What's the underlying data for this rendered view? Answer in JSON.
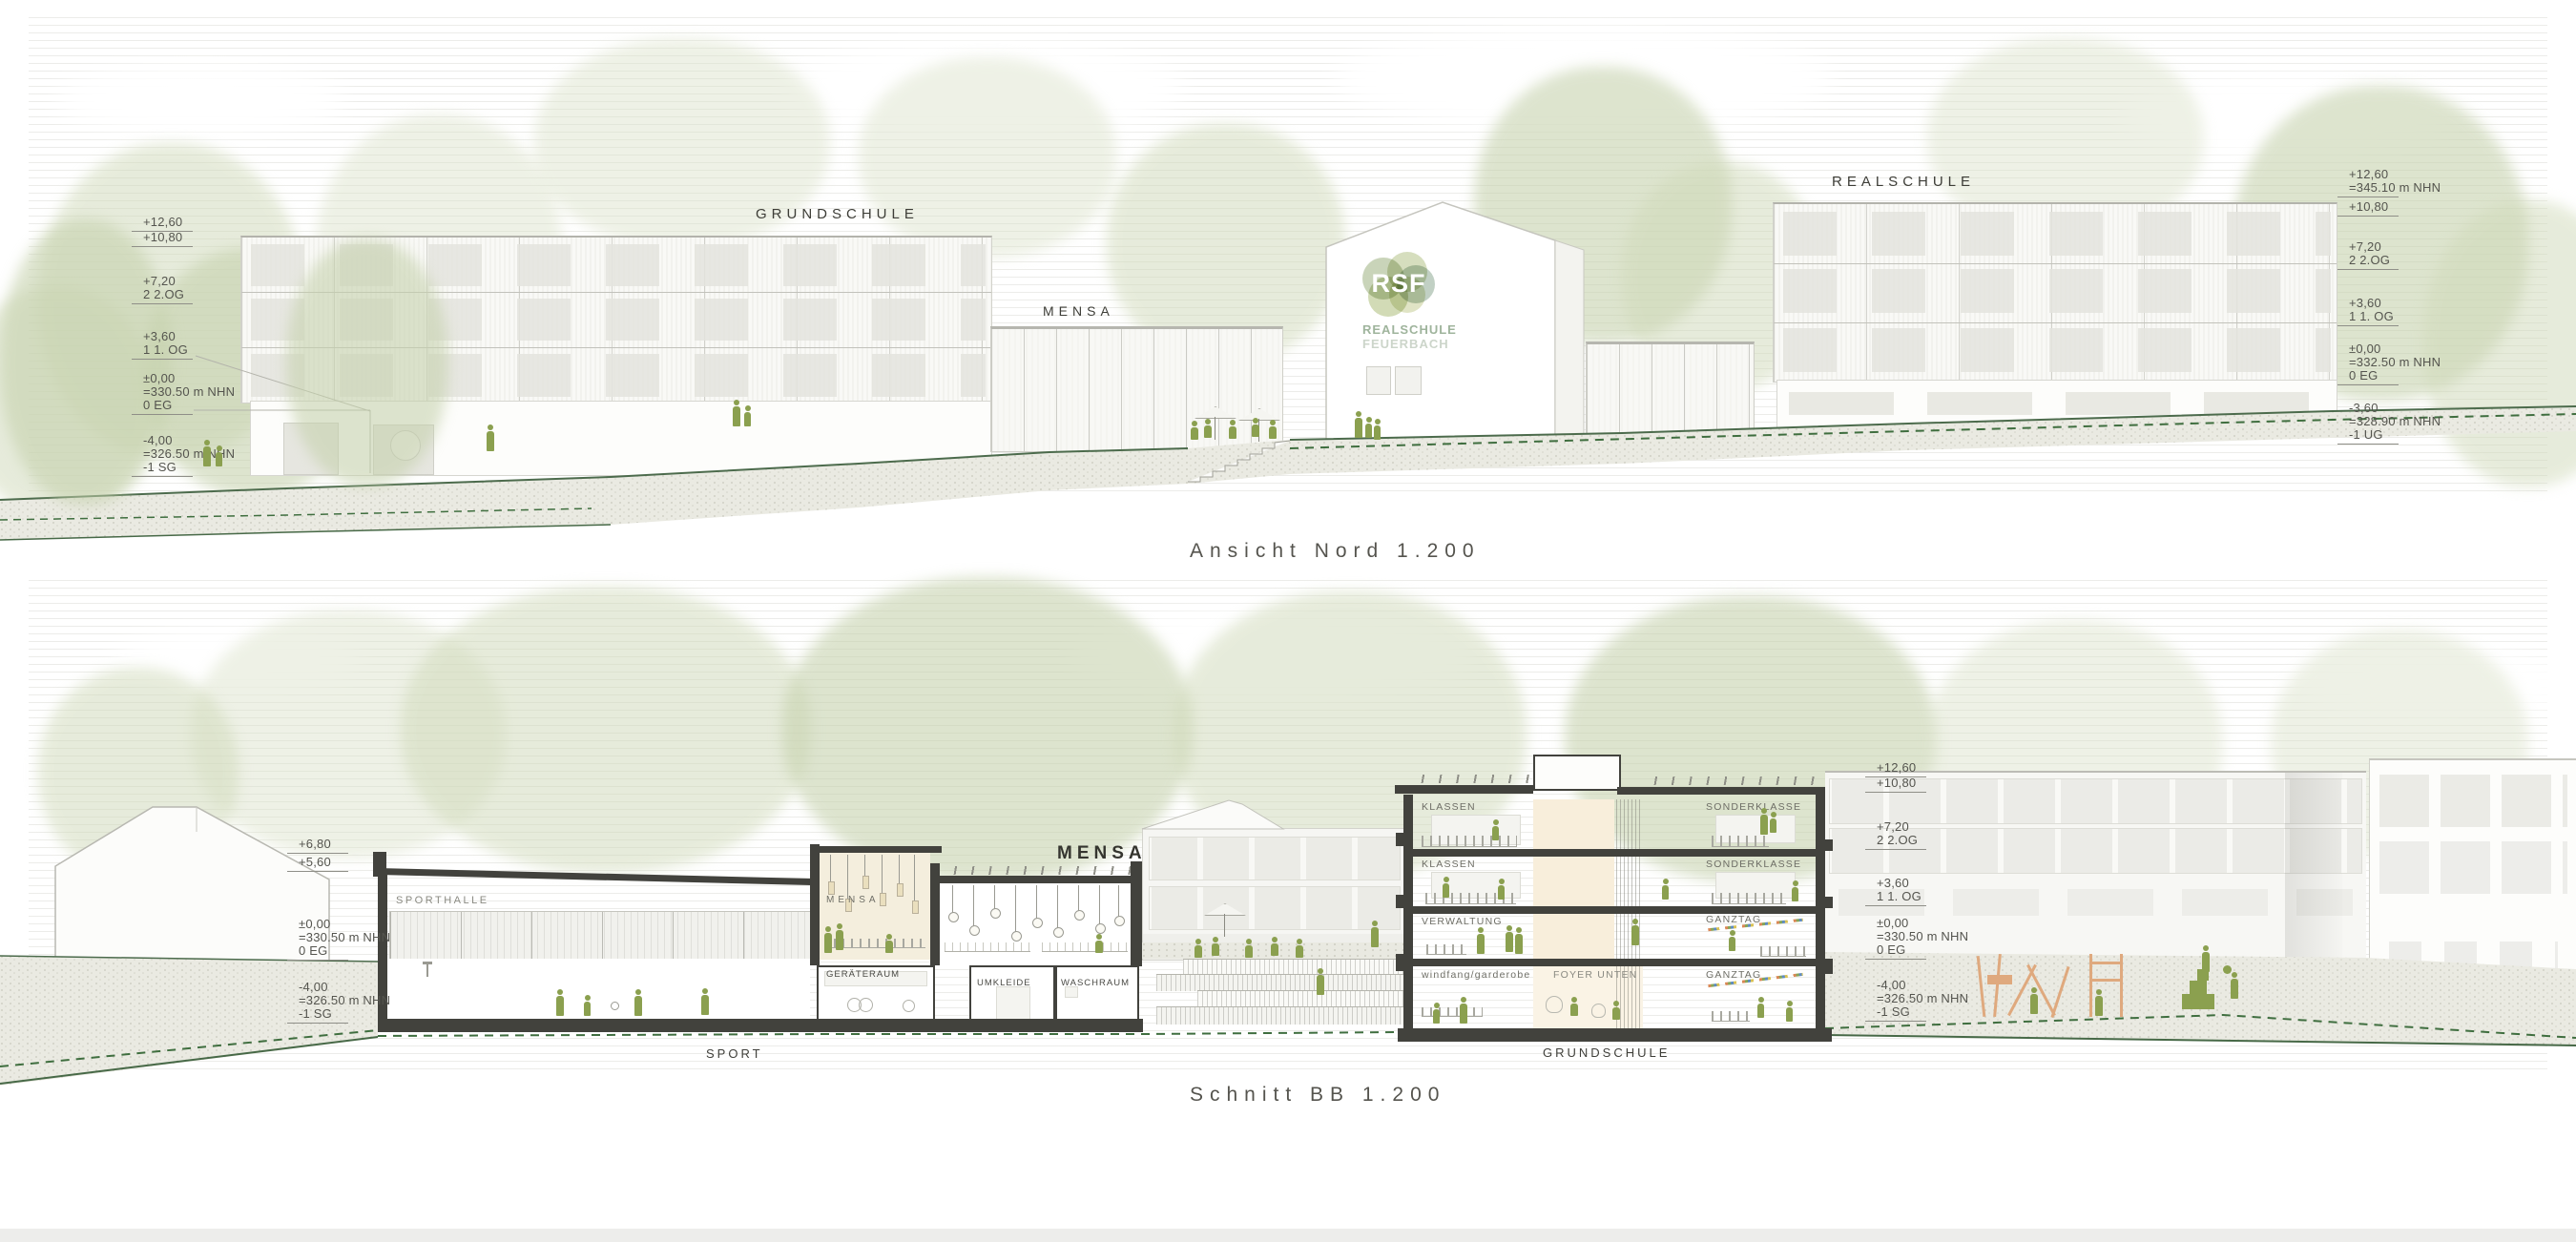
{
  "page": {
    "caption_top": "Ansicht Nord 1.200",
    "caption_bottom": "Schnitt BB 1.200"
  },
  "colors": {
    "figure_green": "#8ba04f",
    "terrain_line_green": "#476947",
    "playground_orange": "#dfa97e",
    "cut_dark": "#42423d",
    "logo_sage": "#9fb49c"
  },
  "nord": {
    "labels": {
      "grundschule": "GRUNDSCHULE",
      "mensa": "MENSA",
      "realschule": "REALSCHULE"
    },
    "logo": {
      "initials": "RSF",
      "line1": "REALSCHULE",
      "line2": "FEUERBACH"
    },
    "markers_left": [
      {
        "lines": [
          "+12,60"
        ]
      },
      {
        "lines": [
          "+10,80"
        ]
      },
      {
        "lines": [
          "+7,20",
          "2 2.OG"
        ]
      },
      {
        "lines": [
          "+3,60",
          "1 1. OG"
        ]
      },
      {
        "lines": [
          "±0,00",
          "=330.50 m NHN",
          "0 EG"
        ]
      },
      {
        "lines": [
          "-4,00",
          "=326.50 m NHN",
          "-1 SG"
        ]
      }
    ],
    "markers_right": [
      {
        "lines": [
          "+12,60",
          "=345.10 m NHN"
        ]
      },
      {
        "lines": [
          "+10,80"
        ]
      },
      {
        "lines": [
          "+7,20",
          "2 2.OG"
        ]
      },
      {
        "lines": [
          "+3,60",
          "1 1. OG"
        ]
      },
      {
        "lines": [
          "±0,00",
          "=332.50 m NHN",
          "0 EG"
        ]
      },
      {
        "lines": [
          "-3,60",
          "=328.90 m NHN",
          "-1 UG"
        ]
      }
    ]
  },
  "schnitt": {
    "labels": {
      "sporthalle": "SPORTHALLE",
      "mensa_small": "MENSA",
      "mensa_large": "MENSA",
      "geraeteraum": "GERÄTERAUM",
      "umkleide": "UMKLEIDE",
      "waschraum": "WASCHRAUM",
      "klassen_1": "KLASSEN",
      "klassen_2": "KLASSEN",
      "verwaltung": "VERWALTUNG",
      "windfang": "windfang/garderobe",
      "foyer": "FOYER UNTEN",
      "sonderklasse_1": "SONDERKLASSE",
      "sonderklasse_2": "SONDERKLASSE",
      "ganztag_1": "GANZTAG",
      "ganztag_2": "GANZTAG",
      "sport": "SPORT",
      "grundschule": "GRUNDSCHULE"
    },
    "markers_left": [
      {
        "lines": [
          "+6,80"
        ]
      },
      {
        "lines": [
          "+5,60"
        ]
      },
      {
        "lines": [
          "±0,00",
          "=330.50 m NHN",
          "0 EG"
        ]
      },
      {
        "lines": [
          "-4,00",
          "=326.50 m NHN",
          "-1 SG"
        ]
      }
    ],
    "markers_right": [
      {
        "lines": [
          "+12,60"
        ]
      },
      {
        "lines": [
          "+10,80"
        ]
      },
      {
        "lines": [
          "+7,20",
          "2 2.OG"
        ]
      },
      {
        "lines": [
          "+3,60",
          "1 1. OG"
        ]
      },
      {
        "lines": [
          "±0,00",
          "=330.50 m NHN",
          "0 EG"
        ]
      },
      {
        "lines": [
          "-4,00",
          "=326.50 m NHN",
          "-1 SG"
        ]
      }
    ]
  }
}
